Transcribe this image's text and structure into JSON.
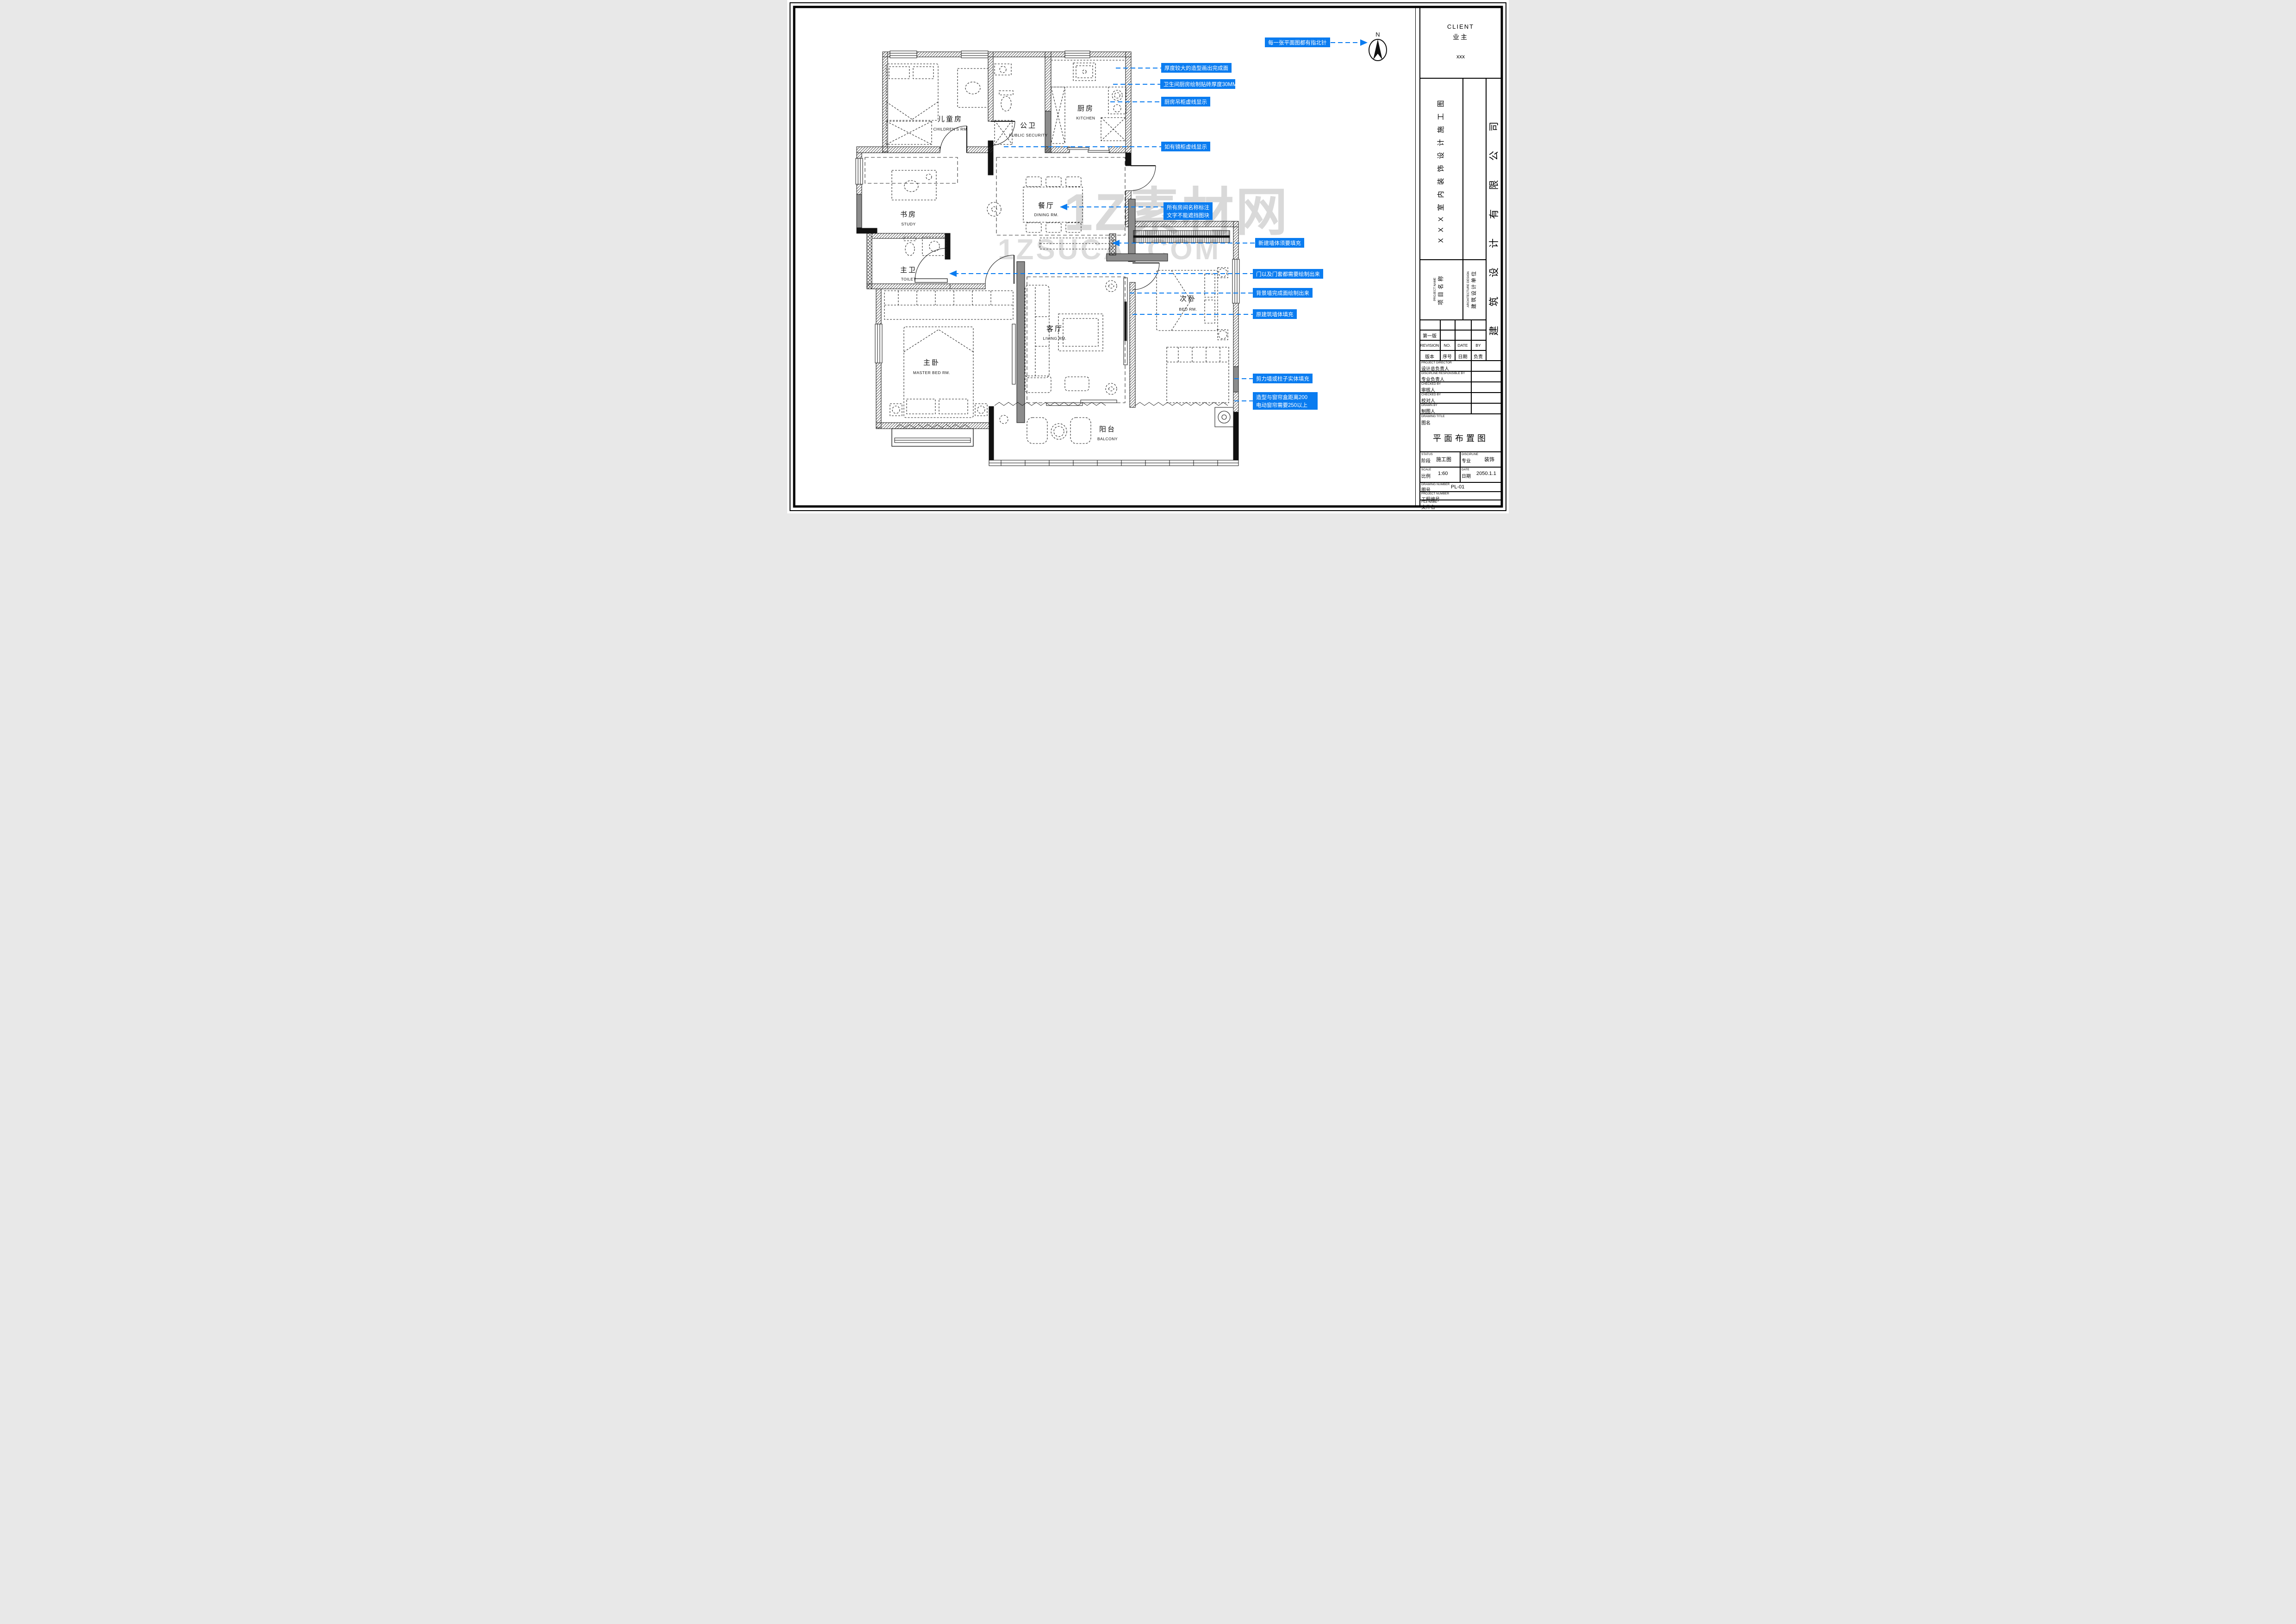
{
  "sheet": {
    "client": {
      "en": "CLIENT",
      "cn": "业主",
      "value": "xxx"
    },
    "sheet_title_vertical": "XXX室内装饰设计施工图",
    "company_vertical": "建筑设计有限公司",
    "project_name": {
      "en": "PROJECT NAME",
      "cn": "项目名称"
    },
    "architecture_design": {
      "en": "ARCHITECTURE DESIGN",
      "cn": "建筑设计单位"
    },
    "revision": {
      "first_version": "第一版",
      "en": {
        "revision": "REVISION",
        "no": "NO.",
        "date": "DATE",
        "by": "BY"
      },
      "cn": {
        "revision": "版本",
        "no": "序号",
        "date": "日期",
        "by": "负责"
      }
    },
    "people": [
      {
        "en": "PROJECT DIRECTOR",
        "cn": "设计总负责人"
      },
      {
        "en": "DISCIPLINE RESPONSIBLE BY",
        "cn": "专业负责人"
      },
      {
        "en": "CHECKED BY",
        "cn": "审核人"
      },
      {
        "en": "CHECKED BY",
        "cn": "校对人"
      },
      {
        "en": "DRAWN BY",
        "cn": "制图人"
      }
    ],
    "drawing_title": {
      "en": "DRAWING TITLE",
      "cn": "图名",
      "value": "平面布置图"
    },
    "status": {
      "en": "STATUS",
      "cn": "阶段",
      "value": "施工图"
    },
    "discipline": {
      "en": "DISCIPLINE",
      "cn": "专业",
      "value": "装饰"
    },
    "scale": {
      "en": "SCALE",
      "cn": "比例",
      "value": "1:60"
    },
    "date": {
      "en": "DATE",
      "cn": "日期",
      "value": "2050.1.1"
    },
    "drawing_number": {
      "en": "DRAWING NUMBER",
      "cn": "图号",
      "value": "PL-01"
    },
    "project_number": {
      "en": "PROJECT NUMBER",
      "cn": "工程编号"
    },
    "file_name": {
      "en": "FILE NAME",
      "cn": "文件名"
    }
  },
  "north": {
    "label": "N"
  },
  "rooms": [
    {
      "cn": "儿童房",
      "en": "CHILDREN'S RM"
    },
    {
      "cn": "公卫",
      "en": "PUBLIC SECURITY"
    },
    {
      "cn": "厨房",
      "en": "KITCHEN"
    },
    {
      "cn": "书房",
      "en": "STUDY"
    },
    {
      "cn": "餐厅",
      "en": "DINING RM."
    },
    {
      "cn": "主卫",
      "en": "TOILET"
    },
    {
      "cn": "主卧",
      "en": "MASTER BED RM."
    },
    {
      "cn": "客厅",
      "en": "LIVING RM."
    },
    {
      "cn": "次卧",
      "en": "BED RM."
    },
    {
      "cn": "阳台",
      "en": "BALCONY"
    }
  ],
  "annotations": [
    {
      "text": "每一张平面图都有指北针"
    },
    {
      "text": "厚度较大的造型画出完成面"
    },
    {
      "text": "卫生间厨房绘制贴砖厚度30MM"
    },
    {
      "text": "厨房吊柜虚线显示"
    },
    {
      "text": "如有镜柜虚线显示"
    },
    {
      "text": "所有房间名称标注",
      "text2": "文字不能遮挡图块"
    },
    {
      "text": "新建墙体须要填充"
    },
    {
      "text": "门以及门套都需要绘制出来"
    },
    {
      "text": "背景墙完成面绘制出来"
    },
    {
      "text": "原建筑墙体填充"
    },
    {
      "text": "剪力墙或柱子实体填充"
    },
    {
      "text": "造型与窗帘盒距离200",
      "text2": "电动窗帘需要250以上"
    }
  ],
  "watermark": {
    "line1": "1Z素材网",
    "line2": "1ZSUCAI.COM"
  },
  "colors": {
    "annotation_blue": "#0a7cf0",
    "shear_wall_gray": "#8c8c8c",
    "watermark_gray": "#b5b5b5"
  }
}
